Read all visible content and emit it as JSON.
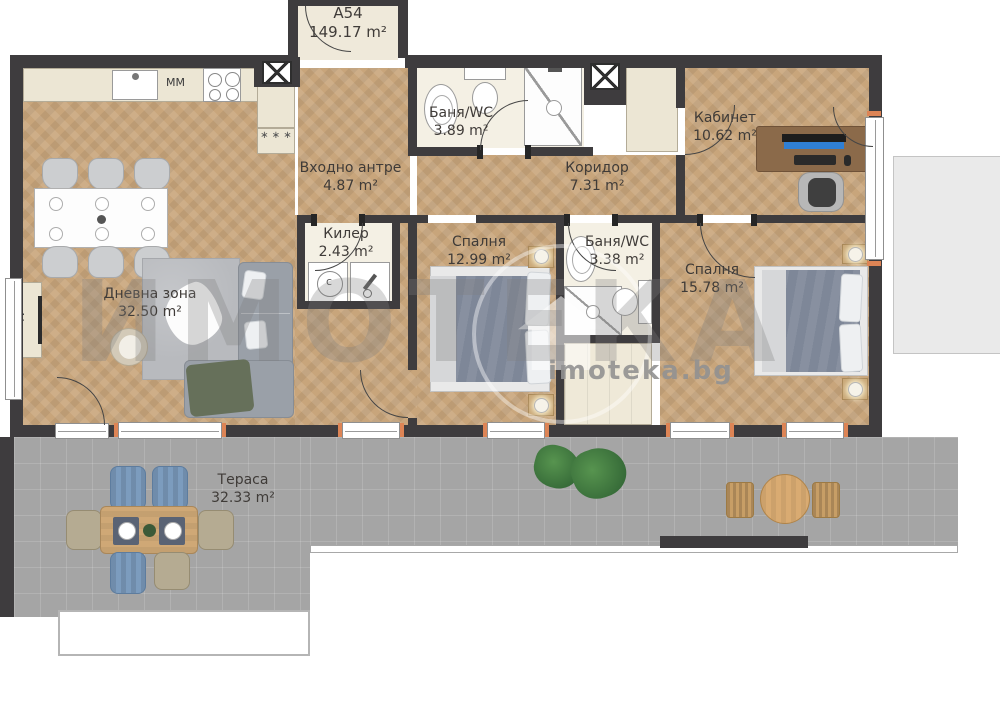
{
  "unit": {
    "id": "A54",
    "area": "149.17 m²"
  },
  "rooms": {
    "living": {
      "name": "Дневна зона",
      "area": "32.50 m²"
    },
    "entry": {
      "name": "Входно антре",
      "area": "4.87 m²"
    },
    "bath1": {
      "name": "Баня/WC",
      "area": "3.89 m²"
    },
    "cabinet": {
      "name": "Кабинет",
      "area": "10.62 m²"
    },
    "corridor": {
      "name": "Коридор",
      "area": "7.31 m²"
    },
    "closet": {
      "name": "Килер",
      "area": "2.43 m²"
    },
    "bedroom1": {
      "name": "Спалня",
      "area": "12.99 m²"
    },
    "bath2": {
      "name": "Баня/WC",
      "area": "3.38 m²"
    },
    "bedroom2": {
      "name": "Спалня",
      "area": "15.78 m²"
    },
    "terrace": {
      "name": "Тераса",
      "area": "32.33 m²"
    }
  },
  "annotations": {
    "kitchen_mm": "MM",
    "tv": "TV",
    "washer_letter": "c",
    "freezer_marks": "∗ ∗ ∗"
  },
  "watermark": {
    "big": "ИМОТЕКА",
    "site": "imoteka.bg"
  },
  "colors": {
    "wall": "#3e3c3e",
    "wood_floor": "#c8a57b",
    "bath_floor": "#f4f0e4",
    "terrace_tile": "#a5a5a5",
    "door_tick_orange": "#dd8455",
    "watermark_gray": "#8c8c8c"
  }
}
